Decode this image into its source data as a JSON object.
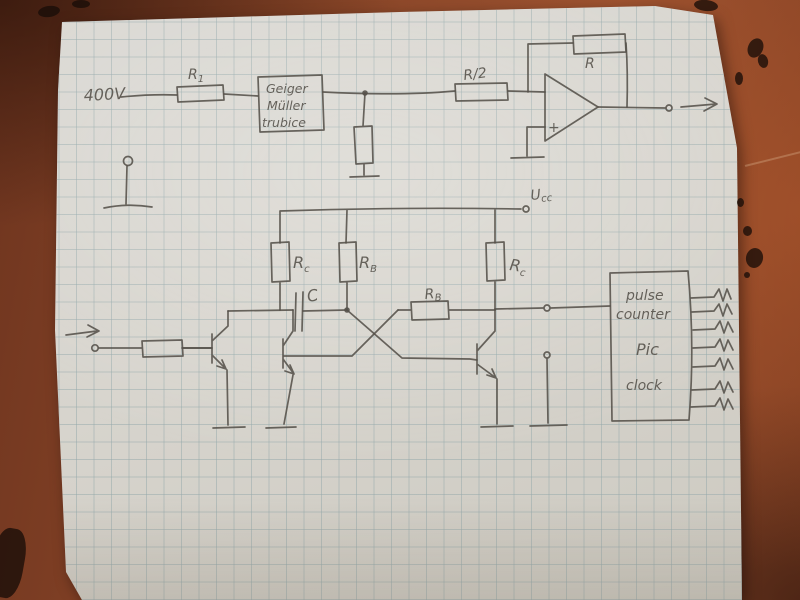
{
  "colors": {
    "table": "#8a4628",
    "paper": "#d7d4cd",
    "pencil": "#55514a",
    "grid": "rgba(148,168,170,0.5)"
  },
  "schematic": {
    "supply_label": "400V",
    "r1": {
      "base": "R",
      "sub": "1"
    },
    "tube_box": [
      "Geiger",
      "Müller",
      "trubice"
    ],
    "divider_label": "R/2",
    "feedback_label": "R",
    "opamp_plus": "+",
    "ucc": {
      "base": "U",
      "sub": "cc"
    },
    "rc_left": {
      "base": "R",
      "sub": "c"
    },
    "rb_left": {
      "base": "R",
      "sub": "B"
    },
    "rb_mid": {
      "base": "R",
      "sub": "B"
    },
    "rc_right": {
      "base": "R",
      "sub": "c"
    },
    "cap_label": "C",
    "counter_box": [
      "pulse",
      "counter",
      "Pic",
      "clock"
    ]
  }
}
